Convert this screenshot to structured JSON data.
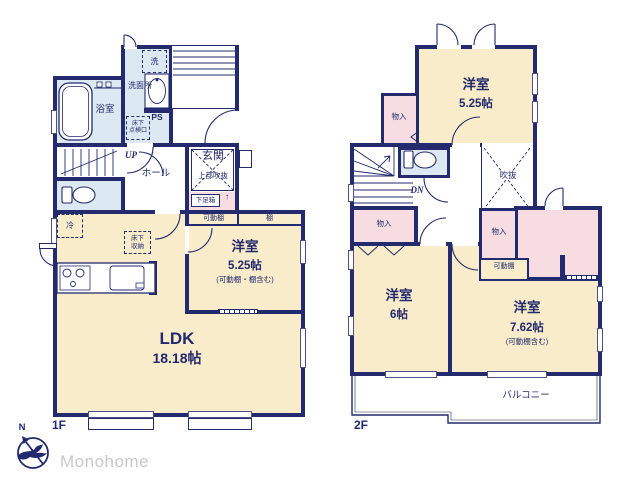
{
  "brand": {
    "logo_text": "Monohome",
    "compass_north": "N"
  },
  "colors": {
    "wall": "#232a6d",
    "room_cream": "#f9ecca",
    "wet_blue": "#dce9f2",
    "closet_pink": "#f7dde2",
    "logo_gray": "#c9c9c9"
  },
  "floor1": {
    "floor_label": "1F",
    "bathroom": "浴室",
    "washroom": "洗面所",
    "washer": "洗",
    "hatch_line1": "床下",
    "hatch_line2": "点検口",
    "ps": "PS",
    "up": "UP",
    "hall": "ホール",
    "entrance": "玄関",
    "entrance_note": "上部吹抜",
    "shoe_box": "下足箱",
    "shoe_arrow": "↑",
    "fridge": "冷",
    "underfloor_line1": "床下",
    "underfloor_line2": "収納",
    "shelf_movable": "可動棚",
    "shelf": "棚",
    "west_room": {
      "name": "洋室",
      "size": "5.25帖",
      "note": "(可動棚・棚含む)"
    },
    "ldk": {
      "name": "LDK",
      "size": "18.18帖"
    }
  },
  "floor2": {
    "floor_label": "2F",
    "room_a": {
      "name": "洋室",
      "size": "5.25帖"
    },
    "closet_top": "物入",
    "closet_left": "物入",
    "closet_center": "物入",
    "dn": "DN",
    "void": "吹抜",
    "shelf_movable": "可動棚",
    "room_b": {
      "name": "洋室",
      "size": "6帖"
    },
    "room_c": {
      "name": "洋室",
      "size": "7.62帖",
      "note": "(可動棚含む)"
    },
    "balcony": "バルコニー"
  }
}
